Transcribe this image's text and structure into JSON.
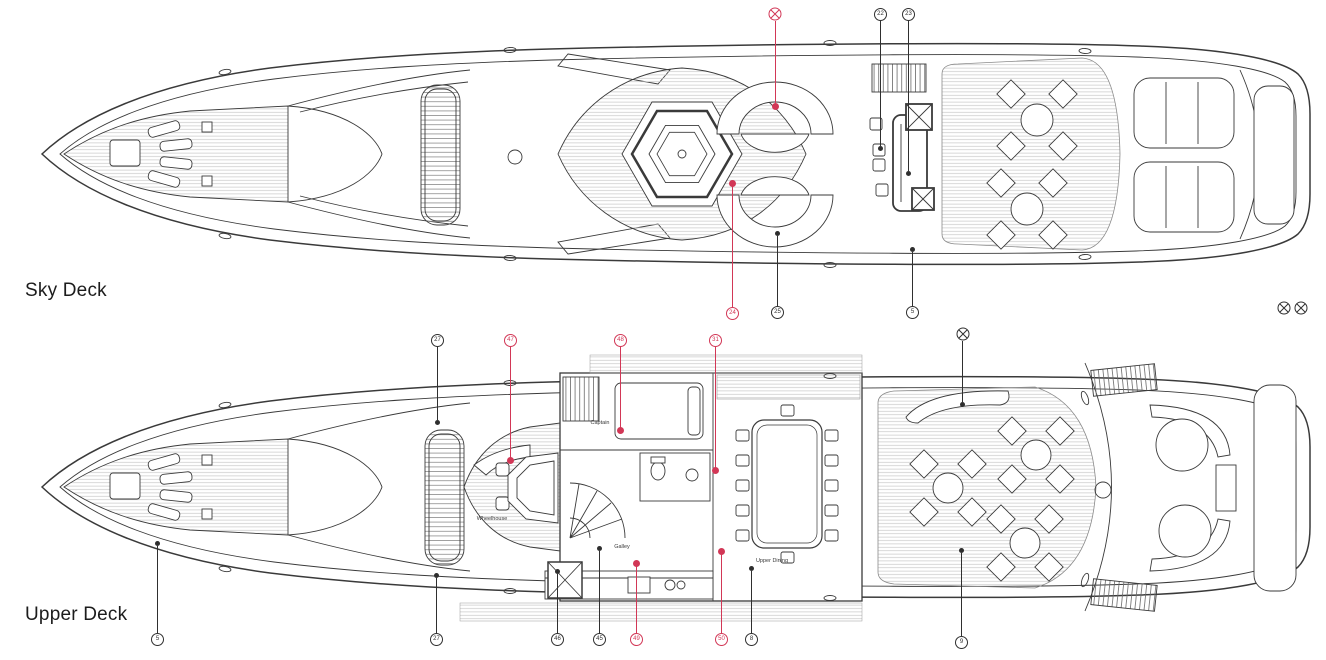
{
  "colors": {
    "accent_red": "#d23756",
    "line": "#2f2f2f"
  },
  "icons": {
    "crossed_circle": "crossed-circle-marker"
  },
  "sky_deck": {
    "title": "Sky Deck",
    "callouts": {
      "n22": "22",
      "n23": "23",
      "n24": "24",
      "n25": "25",
      "n5": "5"
    }
  },
  "upper_deck": {
    "title": "Upper Deck",
    "rooms": {
      "wheelhouse": "Wheelhouse",
      "captain": "Captain",
      "galley": "Galley",
      "upper_dining": "Upper Dining"
    },
    "callouts_top": {
      "n27": "27",
      "n47": "47",
      "n48": "48",
      "n31": "31"
    },
    "callouts_bottom": {
      "n5": "5",
      "n27": "27",
      "n46": "46",
      "n45": "45",
      "n49": "49",
      "n50": "50",
      "n8": "8",
      "n9": "9"
    }
  }
}
